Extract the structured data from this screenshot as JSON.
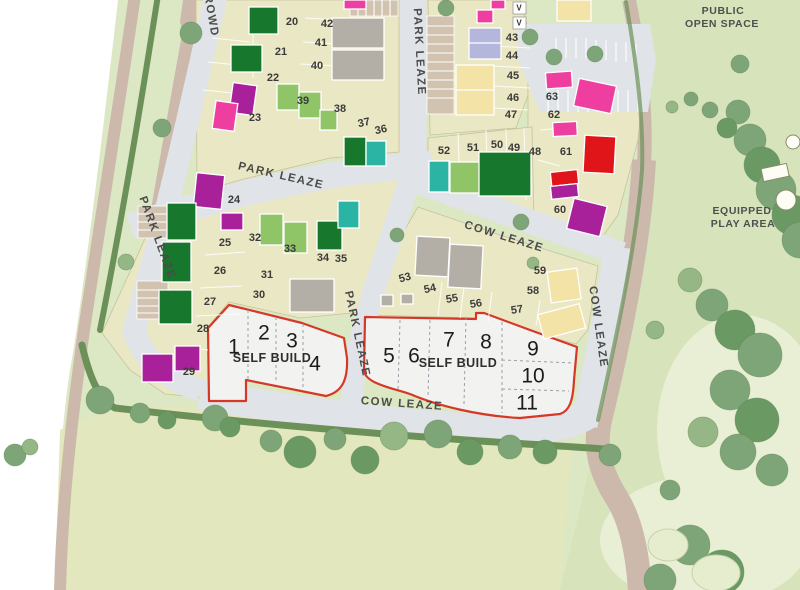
{
  "streets": {
    "park_leaze": "PARK LEAZE",
    "cow_leaze": "COW LEAZE",
    "rowd": "ROWD"
  },
  "areas": {
    "public_open_space_line1": "PUBLIC",
    "public_open_space_line2": "OPEN SPACE",
    "play_area_line1": "EQUIPPED",
    "play_area_line2": "PLAY AREA"
  },
  "self_build": {
    "label": "SELF BUILD",
    "plots": {
      "1": "1",
      "2": "2",
      "3": "3",
      "4": "4",
      "5": "5",
      "6": "6",
      "7": "7",
      "8": "8",
      "9": "9",
      "10": "10",
      "11": "11"
    }
  },
  "plots": {
    "20": "20",
    "21": "21",
    "22": "22",
    "23": "23",
    "24": "24",
    "25": "25",
    "26": "26",
    "27": "27",
    "28": "28",
    "29": "29",
    "30": "30",
    "31": "31",
    "32": "32",
    "33": "33",
    "34": "34",
    "35": "35",
    "36": "36",
    "37": "37",
    "38": "38",
    "39": "39",
    "40": "40",
    "41": "41",
    "42": "42",
    "43": "43",
    "44": "44",
    "45": "45",
    "46": "46",
    "47": "47",
    "48": "48",
    "49": "49",
    "50": "50",
    "51": "51",
    "52": "52",
    "53": "53",
    "54": "54",
    "55": "55",
    "56": "56",
    "57": "57",
    "58": "58",
    "59": "59",
    "60": "60",
    "61": "61",
    "62": "62",
    "63": "63"
  },
  "markers": {
    "visitor": "V"
  },
  "palette": {
    "darkgreen": "#17772d",
    "lightgreen": "#8fc566",
    "teal": "#2bb3a3",
    "magenta": "#a8209a",
    "pink": "#ee3fa0",
    "red": "#e0151a",
    "lavender": "#b5b6db",
    "cream": "#f3e3a6",
    "grayroof": "#b3afa7",
    "tan": "#d2c3b1",
    "road": "#e0e3e7",
    "beige": "#eae8c4",
    "grass": "#dce7c3",
    "openspace": "#d7e3ba",
    "field": "#e3e7bd",
    "playarea": "#e9efd4",
    "hedge": "#6b9159",
    "tree_mid": "#7da577",
    "tree_dark": "#6a9964",
    "tree_light": "#95b685",
    "path": "#ccb9ac",
    "outline_red": "#d53827",
    "text": "#3b3b3b"
  }
}
